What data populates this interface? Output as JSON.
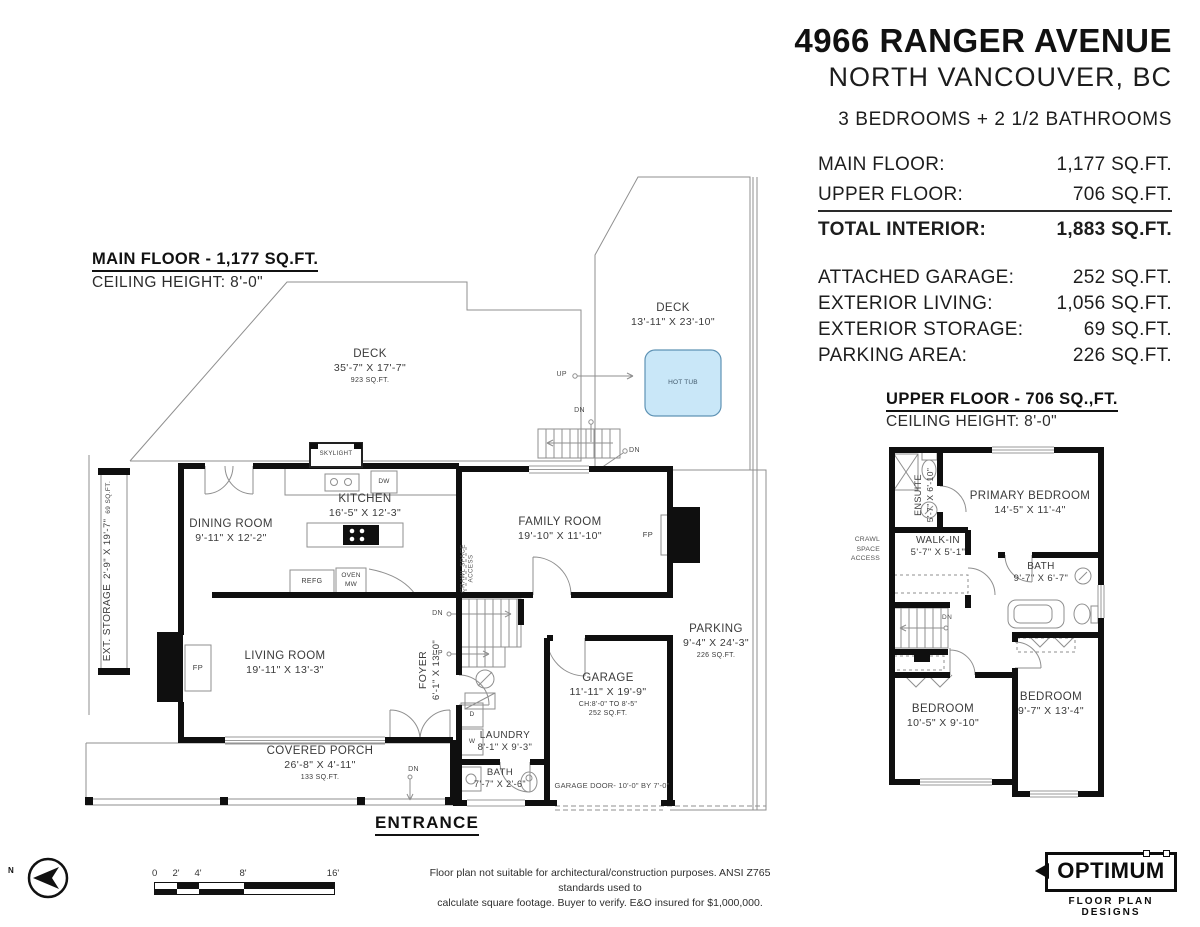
{
  "header": {
    "title": "4966 RANGER AVENUE",
    "subtitle": "NORTH VANCOUVER, BC",
    "summary": "3 BEDROOMS + 2 1/2 BATHROOMS"
  },
  "stats": {
    "interior": [
      {
        "label": "MAIN FLOOR:",
        "value": "1,177 SQ.FT."
      },
      {
        "label": "UPPER FLOOR:",
        "value": "706 SQ.FT."
      },
      {
        "label": "TOTAL INTERIOR:",
        "value": "1,883 SQ.FT."
      }
    ],
    "exterior": [
      {
        "label": "ATTACHED GARAGE:",
        "value": "252 SQ.FT."
      },
      {
        "label": "EXTERIOR LIVING:",
        "value": "1,056 SQ.FT."
      },
      {
        "label": "EXTERIOR STORAGE:",
        "value": "69 SQ.FT."
      },
      {
        "label": "PARKING AREA:",
        "value": "226 SQ.FT."
      }
    ]
  },
  "main_floor": {
    "heading": "MAIN FLOOR - 1,177 SQ.FT.",
    "ceiling": "CEILING HEIGHT: 8'-0\"",
    "deck_main": {
      "name": "DECK",
      "dims": "35'-7\" X 17'-7\"",
      "area": "923 SQ.FT."
    },
    "deck_hot_tub": {
      "name": "DECK",
      "dims": "13'-11\" X 23'-10\""
    },
    "hot_tub": "HOT TUB",
    "kitchen": {
      "name": "KITCHEN",
      "dims": "16'-5\" X 12'-3\""
    },
    "dining_room": {
      "name": "DINING ROOM",
      "dims": "9'-11\" X 12'-2\""
    },
    "family_room": {
      "name": "FAMILY ROOM",
      "dims": "19'-10\" X 11'-10\""
    },
    "living_room": {
      "name": "LIVING ROOM",
      "dims": "19'-11\" X 13'-3\""
    },
    "foyer": {
      "name": "FOYER",
      "dims": "6'-1\" X 13'-0\""
    },
    "garage": {
      "name": "GARAGE",
      "dims": "11'-11\" X 19'-9\"",
      "ceiling": "CH:8'-0\" TO 8'-5\"",
      "area": "252 SQ.FT."
    },
    "laundry": {
      "name": "LAUNDRY",
      "dims": "8'-1\" X 9'-3\""
    },
    "bath": {
      "name": "BATH",
      "dims": "7'-7\" X 2'-6\""
    },
    "covered_porch": {
      "name": "COVERED PORCH",
      "dims": "26'-8\" X 4'-11\"",
      "area": "133 SQ.FT."
    },
    "parking": {
      "name": "PARKING",
      "dims": "9'-4\" X 24'-3\"",
      "area": "226 SQ.FT."
    },
    "ext_storage": {
      "name": "EXT. STORAGE",
      "dims": "2'-9\" X 19'-7\"",
      "area": "69 SQ.FT."
    },
    "crawl_space": "CRAWL SPACE ACCESS",
    "skylight": "SKYLIGHT",
    "dw": "DW",
    "refg": "REFG",
    "oven": "OVEN",
    "mw": "MW",
    "fp": "FP",
    "dryer": "D",
    "washer": "W",
    "up": "UP",
    "dn": "DN",
    "entrance": "ENTRANCE",
    "garage_door": "GARAGE DOOR- 10'-0\" BY 7'-0\""
  },
  "upper_floor": {
    "heading": "UPPER FLOOR - 706 SQ.,FT.",
    "ceiling": "CEILING HEIGHT: 8'-0\"",
    "primary_bedroom": {
      "name": "PRIMARY BEDROOM",
      "dims": "14'-5\" X 11'-4\""
    },
    "ensuite": {
      "name": "ENSUITE",
      "dims": "5'-7\" X 6'-10\""
    },
    "walk_in": {
      "name": "WALK-IN",
      "dims": "5'-7\" X 5'-1\""
    },
    "bath": {
      "name": "BATH",
      "dims": "9'-7\" X 6'-7\""
    },
    "bedroom_left": {
      "name": "BEDROOM",
      "dims": "10'-5\" X 9'-10\""
    },
    "bedroom_right": {
      "name": "BEDROOM",
      "dims": "9'-7\" X 13'-4\""
    },
    "crawl_line1": "CRAWL SPACE",
    "crawl_line2": "ACCESS",
    "dn": "DN"
  },
  "footer": {
    "disclaimer_line1": "Floor plan not suitable for architectural/construction purposes. ANSI Z765 standards used to",
    "disclaimer_line2": "calculate square footage. Buyer to verify.  E&O insured for $1,000,000.",
    "north_label": "N",
    "scale": {
      "labels": [
        "0",
        "2'",
        "4'",
        "8'",
        "16'"
      ]
    },
    "logo": {
      "brand": "OPTIMUM",
      "tagline": "FLOOR PLAN DESIGNS"
    }
  },
  "colors": {
    "wall": "#0f0f0f",
    "line": "#8f8f8f",
    "hot_tub_fill": "#c9e7f8",
    "hot_tub_stroke": "#5f93b5"
  }
}
